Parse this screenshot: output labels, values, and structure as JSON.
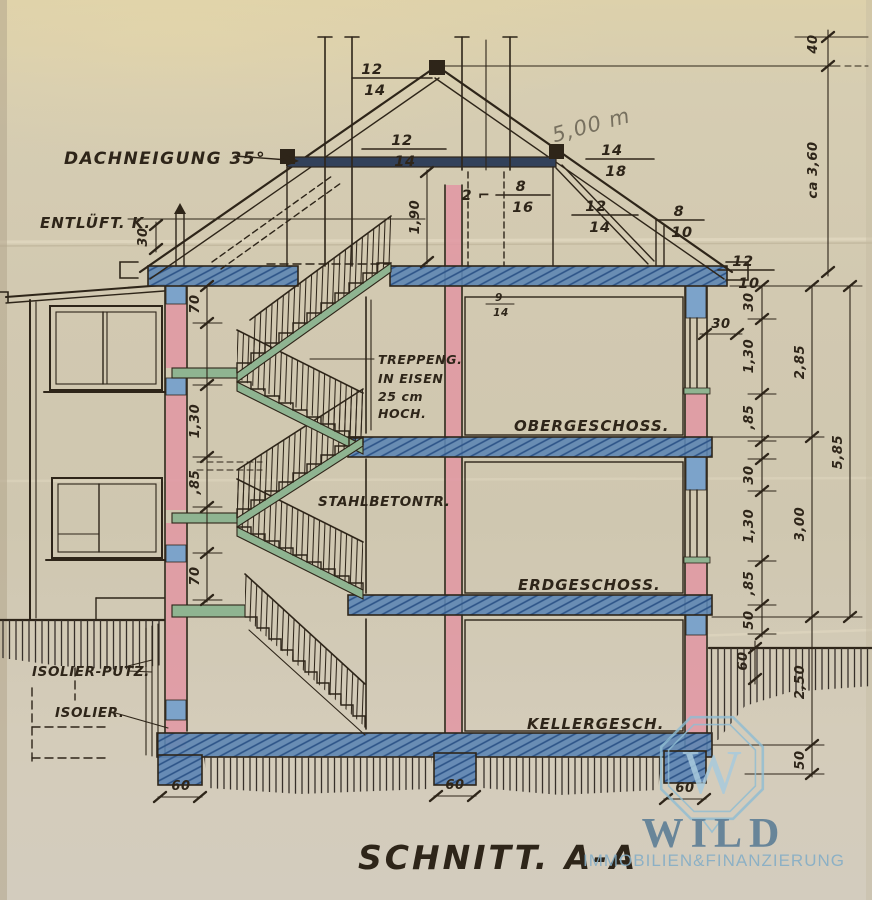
{
  "sheet": {
    "title": "SCHNITT. A-A"
  },
  "labels": {
    "roof_pitch": "DACHNEIGUNG 35°",
    "vent": "ENTLÜFT. K.",
    "stair_l1": "TREPPENG.",
    "stair_l2": "IN EISEN",
    "stair_l3": "25 cm",
    "stair_l4": "HOCH.",
    "stair_concrete": "STAHLBETONTR.",
    "floor_upper": "OBERGESCHOSS.",
    "floor_ground": "ERDGESCHOSS.",
    "floor_basement": "KELLERGESCH.",
    "iso_putz": "ISOLIER-PUTZ.",
    "iso": "ISOLIER."
  },
  "timber": {
    "ridge_n": "12",
    "ridge_d": "14",
    "mid_n": "12",
    "mid_d": "14",
    "purlin_n": "14",
    "purlin_d": "18",
    "collar_prefix": "2 ⌐",
    "collar_n": "8",
    "collar_d": "16",
    "strut_n": "12",
    "strut_d": "14",
    "post_n": "8",
    "post_d": "10",
    "eave_n": "12",
    "eave_d": "10",
    "beam_n": "9",
    "beam_d": "14"
  },
  "dims": {
    "pencil_span": "5,00 m",
    "chimney_top": "40",
    "ridge_height": "ca 3,60",
    "right_inner": [
      "30",
      "1,30",
      ",85",
      "30",
      "1,30",
      ",85",
      "50"
    ],
    "right_mid": [
      "2,85",
      "3,00",
      "2,50",
      "50"
    ],
    "right_outer": "5,85",
    "ground_offset": "60",
    "left_chain": [
      "70",
      "1,30",
      ",85",
      "70"
    ],
    "vent_offset": "30",
    "wall_thickness": "30",
    "attic_height": "1,90",
    "footings": [
      "60",
      "60",
      "60"
    ]
  },
  "watermark": {
    "monogram": "W",
    "brand": "WILD",
    "subtitle": "IMMOBILIEN&FINANZIERUNG"
  },
  "colors": {
    "ink": "#2e2519",
    "wall_pink": "#e297a3",
    "slab_blue": "#5d86b4",
    "lintel_blue": "#7ca3ca",
    "stair_green": "#8fb491",
    "watermark_blue": "#8fbdd3",
    "paper": "#d3cab2",
    "pencil": "#77705f"
  }
}
